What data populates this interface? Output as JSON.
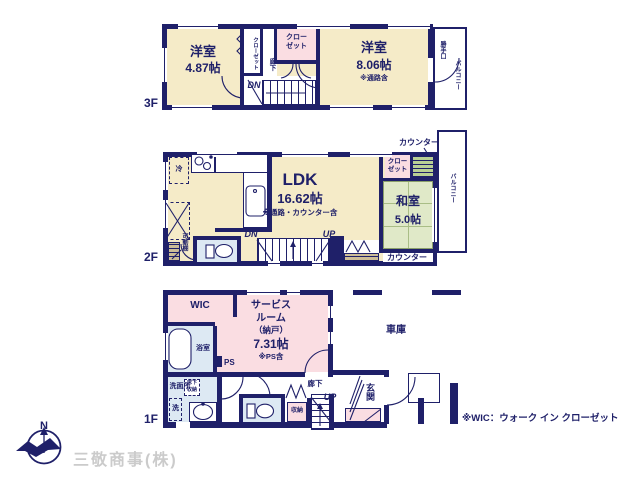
{
  "page": {
    "footnote": "※WIC：ウォーク イン クローゼット",
    "company": "三敬商事(株)",
    "compass_north": "N",
    "colors": {
      "wall_navy": "#1f2069",
      "room_cream": "#f5ebc8",
      "closet_pink": "#fadde2",
      "wet_blue": "#dde9f3",
      "tatami_green": "#e0e9c8",
      "counter_green": "#b9cf95",
      "shelf_wood": "#cdbd97",
      "company_gray": "#cbcbcb"
    }
  },
  "floor3": {
    "label": "3F",
    "room_small": {
      "name": "洋室",
      "size": "4.87帖"
    },
    "room_large": {
      "name": "洋室",
      "size": "8.06帖",
      "note": "※通路含"
    },
    "closet_side": "クローゼット",
    "closet_main_l1": "クロー",
    "closet_main_l2": "ゼット",
    "hallway": "廊下",
    "down": "DN",
    "back_door": "勝手口",
    "balcony": "バルコニー"
  },
  "floor2": {
    "label": "2F",
    "ldk": {
      "name": "LDK",
      "size": "16.62帖",
      "note": "※通路・カウンター含"
    },
    "fridge": "冷",
    "shelf": "可動棚",
    "down": "DN",
    "up": "UP",
    "closet_l1": "クロー",
    "closet_l2": "ゼット",
    "counter_top": "カウンター",
    "counter_bottom": "カウンター",
    "tatami_room": {
      "name": "和室",
      "size": "5.0帖"
    },
    "balcony": "バルコニー"
  },
  "floor1": {
    "label": "1F",
    "wic": "WIC",
    "service_room": {
      "l1": "サービス",
      "l2": "ルーム",
      "l3": "（納戸）",
      "size": "7.31帖",
      "note": "※PS含"
    },
    "bath": "浴室",
    "washroom": "洗面所",
    "underfloor_l1": "床下",
    "underfloor_l2": "収納",
    "laundry": "洗",
    "ps": "PS",
    "storage": "収納",
    "hallway": "廊下",
    "up": "UP",
    "entrance": "玄関",
    "garage": "車庫"
  }
}
